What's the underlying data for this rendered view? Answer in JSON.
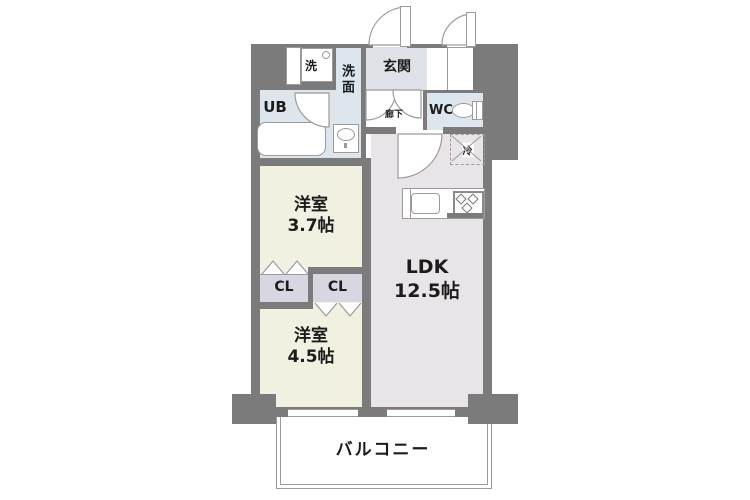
{
  "colors": {
    "wall": "#7b7b7b",
    "western_room_fill": "#f1f0e1",
    "ldk_fill": "#e9e4e8",
    "wet_area_fill": "#dce6ec",
    "entrance_fill": "#dfe1e8",
    "closet_fill": "#d8d6e0",
    "line": "#9b9b9b",
    "text": "#1c1c1c"
  },
  "rooms": {
    "entrance": {
      "label": "玄関"
    },
    "washroom": {
      "label": "洗面"
    },
    "washer": {
      "label": "洗"
    },
    "unit_bath": {
      "label": "UB"
    },
    "toilet": {
      "label": "WC"
    },
    "hallway": {
      "label": "廊下"
    },
    "refrigerator": {
      "label": "冷"
    },
    "western_room_37": {
      "label": "洋室",
      "size": "3.7帖"
    },
    "western_room_45": {
      "label": "洋室",
      "size": "4.5帖"
    },
    "ldk": {
      "label": "LDK",
      "size": "12.5帖"
    },
    "closet_left": {
      "label": "CL"
    },
    "closet_right": {
      "label": "CL"
    },
    "balcony": {
      "label": "バルコニー"
    }
  }
}
